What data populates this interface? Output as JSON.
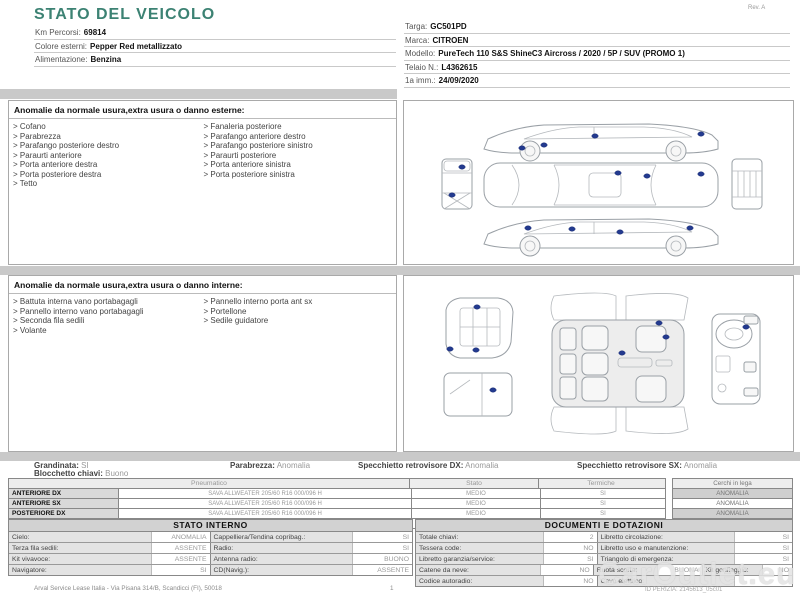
{
  "doc": {
    "title": "STATO DEL VEICOLO",
    "rev": "Rev. A",
    "accent_color": "#3c8273",
    "marker_color": "#233a8f"
  },
  "vehicle_left": [
    {
      "label": "Km Percorsi:",
      "value": "69814"
    },
    {
      "label": "Colore esterni:",
      "value": "Pepper Red metallizzato"
    },
    {
      "label": "Alimentazione:",
      "value": "Benzina"
    }
  ],
  "vehicle_right": [
    {
      "label": "Targa:",
      "value": "GC501PD"
    },
    {
      "label": "Marca:",
      "value": "CITROEN"
    },
    {
      "label": "Modello:",
      "value": "PureTech 110 S&S ShineC3 Aircross / 2020 / 5P / SUV (PROMO 1)"
    },
    {
      "label": "Telaio N.:",
      "value": "L4362615"
    },
    {
      "label": "1a imm.:",
      "value": "24/09/2020"
    }
  ],
  "exterior_section": {
    "title": "Anomalie da normale usura,extra usura o danno esterne:",
    "items_left": [
      "Cofano",
      "Parabrezza",
      "Parafango posteriore destro",
      "Paraurti anteriore",
      "Porta anteriore destra",
      "Porta posteriore destra",
      "Tetto"
    ],
    "items_right": [
      "Fanaleria posteriore",
      "Parafango anteriore destro",
      "Parafango posteriore sinistro",
      "Paraurti posteriore",
      "Porta anteriore sinistra",
      "Porta posteriore sinistra"
    ]
  },
  "interior_section": {
    "title": "Anomalie da normale usura,extra usura o danno interne:",
    "items_left": [
      "Battuta interna vano portabagagli",
      "Pannello interno vano portabagagli",
      "Seconda fila sedili",
      "Volante"
    ],
    "items_right": [
      "Pannello interno porta ant sx",
      "Portellone",
      "Sedile guidatore"
    ]
  },
  "diagrams": {
    "exterior_markers": [
      [
        191,
        35
      ],
      [
        140,
        44
      ],
      [
        118,
        47
      ],
      [
        297,
        33
      ],
      [
        58,
        66
      ],
      [
        48,
        94
      ],
      [
        214,
        72
      ],
      [
        243,
        75
      ],
      [
        297,
        73
      ],
      [
        124,
        127
      ],
      [
        168,
        128
      ],
      [
        216,
        131
      ],
      [
        286,
        127
      ]
    ],
    "interior_markers": [
      [
        73,
        31
      ],
      [
        46,
        73
      ],
      [
        72,
        74
      ],
      [
        89,
        114
      ],
      [
        255,
        47
      ],
      [
        262,
        61
      ],
      [
        218,
        77
      ],
      [
        342,
        51
      ]
    ]
  },
  "summary": [
    {
      "label": "Grandinata:",
      "value": "SI"
    },
    {
      "label": "Blocchetto chiavi:",
      "value": "Buono"
    },
    {
      "label": "Parabrezza:",
      "value": "Anomalia"
    },
    {
      "label": "Specchietto retrovisore DX:",
      "value": "Anomalia"
    },
    {
      "label": "Specchietto retrovisore SX:",
      "value": "Anomalia"
    }
  ],
  "tyres": {
    "headers": {
      "pneumatico": "Pneumatico",
      "stato": "Stato",
      "termiche": "Termiche",
      "cerchi": "Cerchi in lega"
    },
    "rows": [
      {
        "position": "ANTERIORE DX",
        "tyre": "SAVA ALLWEATER 205/60 R16 000/096 H",
        "stato": "MEDIO",
        "termiche": "SI",
        "cerchi": "ANOMALIA"
      },
      {
        "position": "ANTERIORE SX",
        "tyre": "SAVA ALLWEATER 205/60 R16 000/096 H",
        "stato": "MEDIO",
        "termiche": "SI",
        "cerchi": "ANOMALIA"
      },
      {
        "position": "POSTERIORE DX",
        "tyre": "SAVA ALLWEATER 205/60 R16 000/096 H",
        "stato": "MEDIO",
        "termiche": "SI",
        "cerchi": "ANOMALIA"
      },
      {
        "position": "POSTERIORE SX",
        "tyre": "SAVA ALLWEATER 205/60 R16 000/096 H",
        "stato": "MEDIO",
        "termiche": "SI",
        "cerchi": "ANOMALIA"
      }
    ]
  },
  "stato_interno": {
    "title": "STATO INTERNO",
    "rows": [
      [
        {
          "l": "Cielo:",
          "v": "ANOMALIA"
        },
        {
          "l": "Cappelliera/Tendina copribag.:",
          "v": "SI"
        }
      ],
      [
        {
          "l": "Terza fila sedili:",
          "v": "ASSENTE"
        },
        {
          "l": "Radio:",
          "v": "SI"
        }
      ],
      [
        {
          "l": "Kit vivavoce:",
          "v": "ASSENTE"
        },
        {
          "l": "Antenna radio:",
          "v": "BUONO"
        }
      ],
      [
        {
          "l": "Navigatore:",
          "v": "SI"
        },
        {
          "l": "CD(Navig.):",
          "v": "ASSENTE"
        }
      ]
    ]
  },
  "documenti": {
    "title": "DOCUMENTI E DOTAZIONI",
    "rows": [
      [
        {
          "l": "Totale chiavi:",
          "v": "2"
        },
        {
          "l": "Libretto circolazione:",
          "v": "SI"
        }
      ],
      [
        {
          "l": "Tessera code:",
          "v": "NO"
        },
        {
          "l": "Libretto uso e manutenzione:",
          "v": "SI"
        }
      ],
      [
        {
          "l": "Libretto garanzia/service:",
          "v": "SI"
        },
        {
          "l": "Triangolo di emergenza:",
          "v": "SI"
        }
      ],
      [
        {
          "l": "Catene da neve:",
          "v": "NO"
        },
        {
          "l": "Ruota scorta:",
          "v": "BUONA"
        },
        {
          "l": "Kit gonfiaggio:",
          "v": "NO"
        }
      ],
      [
        {
          "l": "Codice autoradio:",
          "v": "NO"
        },
        {
          "l": "Cavo elettrico:",
          "v": ""
        }
      ]
    ]
  },
  "footer": {
    "company": "Arval Service Lease Italia - Via Pisana 314/B, Scandicci (FI), 50018",
    "page": "1",
    "watermark": "CarOutlet.eu",
    "perizia_id": "ID PERIZIA: 2145613_05c01"
  }
}
